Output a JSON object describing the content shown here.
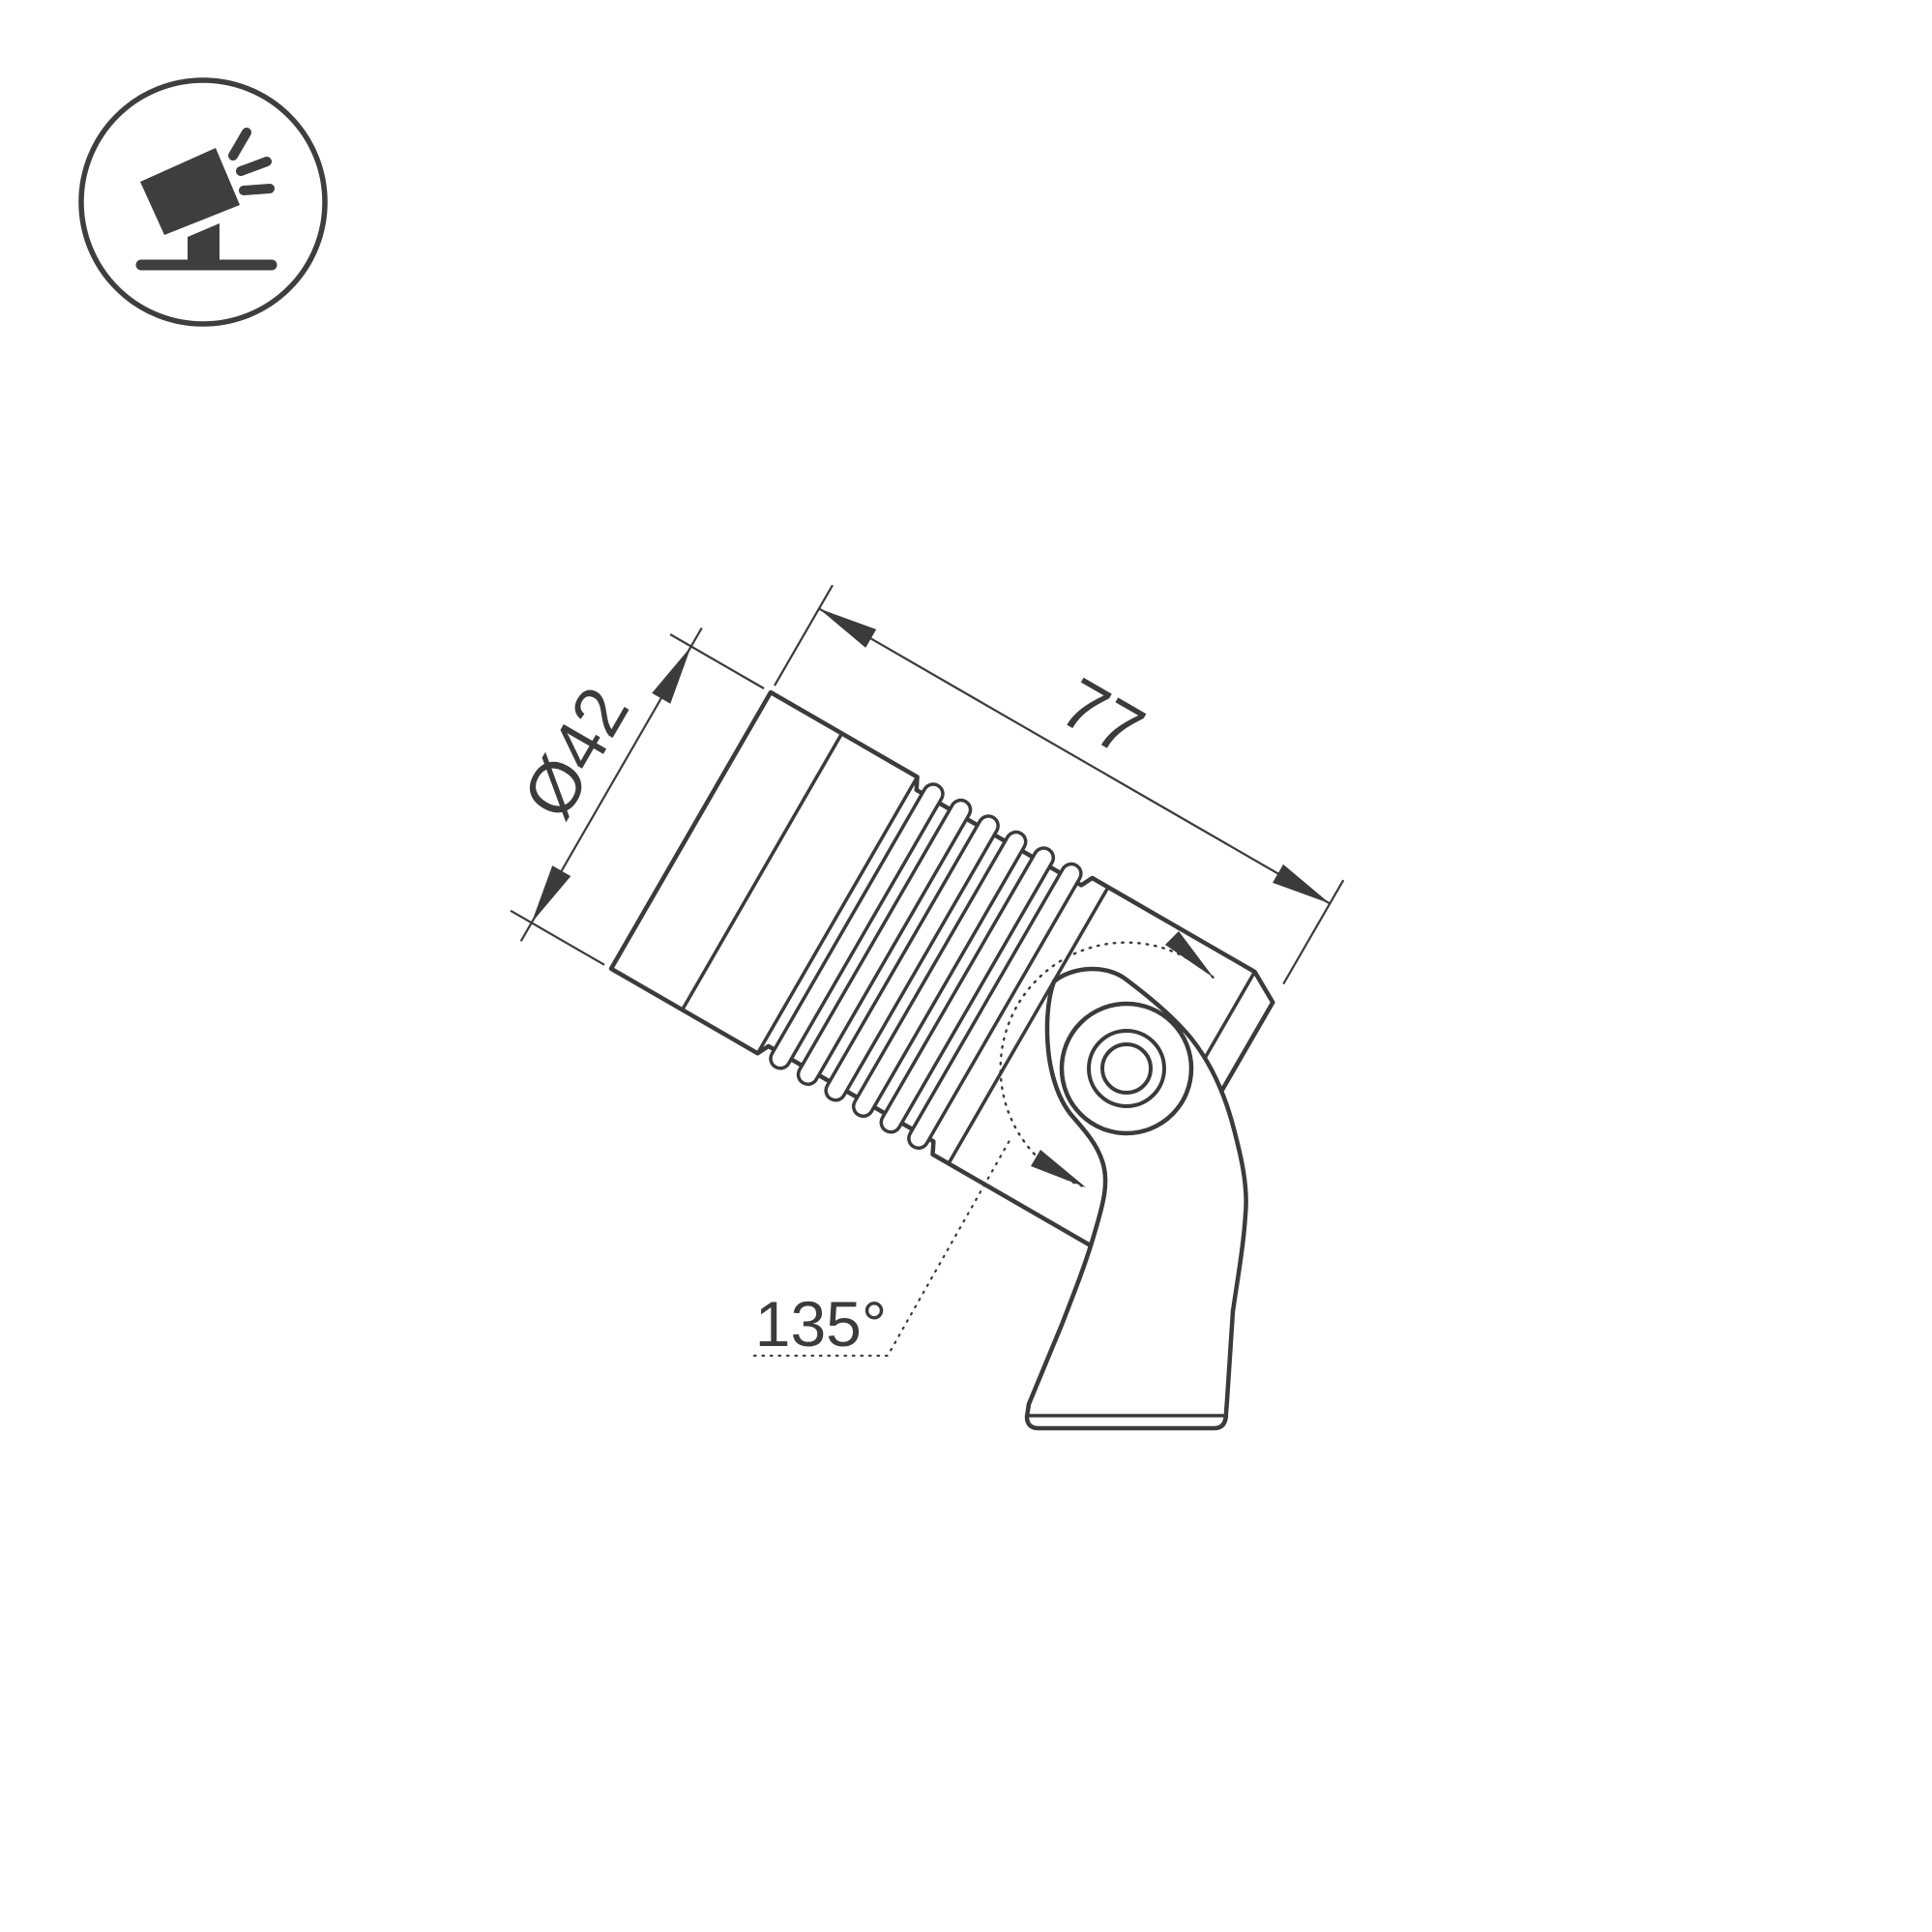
{
  "page": {
    "background": "#ffffff",
    "line_color": "#3b3b3b",
    "icon_color": "#3e3e3e"
  },
  "corner_icon": {
    "name": "tilted-spotlight-icon",
    "description": "circled pictogram of a spotlight tilted up-left on a ground stand emitting three light rays"
  },
  "drawing": {
    "type": "technical-dimension-drawing",
    "subject": "adjustable LED spotlight on swivel bracket, side view",
    "dimensions": {
      "diameter_label": "Ø42",
      "length_label": "77",
      "angle_label": "135°"
    }
  }
}
